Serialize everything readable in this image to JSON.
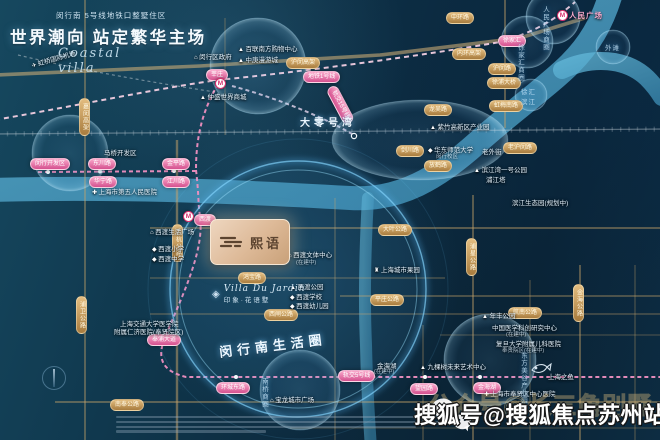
{
  "header": {
    "tagline": "闵行南 5号线地铁口整墅住区",
    "title": "世界潮向 站定繁华主场",
    "script": "Coastal villa"
  },
  "project": {
    "logo": "熙语",
    "script": "Villa Du Jardin",
    "name": "印象·花语墅"
  },
  "watermark": {
    "text": "搜狐号@搜狐焦点苏州站",
    "ghost": "公众号@长三角别墅"
  },
  "colors": {
    "station_pink": "#d5518f",
    "road_gold": "#a87c3e",
    "river_blue": "#58aed2",
    "glow_cyan": "#7fd4ff",
    "card_beige": "#ddb997"
  },
  "map": {
    "icon_glyphs": {
      "tri": "▲",
      "sch": "◆",
      "hos": "✚",
      "bld": "⌂",
      "pag": "♜",
      "pln": "✈"
    },
    "stations": [
      {
        "t": "莘庄",
        "x": 206,
        "y": 69
      },
      {
        "t": "闵行开发区",
        "x": 30,
        "y": 158
      },
      {
        "t": "东川路",
        "x": 88,
        "y": 158
      },
      {
        "t": "金平路",
        "x": 162,
        "y": 158
      },
      {
        "t": "华宁路",
        "x": 89,
        "y": 176
      },
      {
        "t": "江川路",
        "x": 162,
        "y": 176
      },
      {
        "t": "西渡",
        "x": 194,
        "y": 214
      },
      {
        "t": "奉浦大道",
        "x": 147,
        "y": 334
      },
      {
        "t": "环城东路",
        "x": 216,
        "y": 382
      },
      {
        "t": "望园路",
        "x": 410,
        "y": 383
      },
      {
        "t": "金海湖",
        "x": 473,
        "y": 382
      },
      {
        "t": "徐家汇",
        "x": 498,
        "y": 35
      },
      {
        "t": "地铁1号线",
        "x": 303,
        "y": 71
      },
      {
        "t": "轨交5号线",
        "x": 338,
        "y": 370
      },
      {
        "t": "轨交15号线",
        "x": 336,
        "y": 84,
        "rot": 62
      }
    ],
    "roads": [
      {
        "t": "中环路",
        "x": 446,
        "y": 12
      },
      {
        "t": "内环高架",
        "x": 452,
        "y": 48
      },
      {
        "t": "沪闵路",
        "x": 488,
        "y": 63
      },
      {
        "t": "徐浦大桥",
        "x": 487,
        "y": 77
      },
      {
        "t": "沪闵高架",
        "x": 286,
        "y": 57
      },
      {
        "t": "嘉闵高架",
        "x": 79,
        "y": 98,
        "v": 1
      },
      {
        "t": "龙吴路",
        "x": 424,
        "y": 104
      },
      {
        "t": "虹梅南路",
        "x": 489,
        "y": 100
      },
      {
        "t": "剑川路",
        "x": 396,
        "y": 145
      },
      {
        "t": "老沪闵路",
        "x": 503,
        "y": 142
      },
      {
        "t": "放鹤路",
        "x": 424,
        "y": 160
      },
      {
        "t": "沪杭公路",
        "x": 172,
        "y": 224,
        "v": 1
      },
      {
        "t": "大叶公路",
        "x": 378,
        "y": 224
      },
      {
        "t": "浦星公路",
        "x": 466,
        "y": 238,
        "v": 1
      },
      {
        "t": "鸿宝路",
        "x": 238,
        "y": 272
      },
      {
        "t": "平庄公路",
        "x": 370,
        "y": 294
      },
      {
        "t": "西闸公路",
        "x": 264,
        "y": 309
      },
      {
        "t": "航南公路",
        "x": 508,
        "y": 307
      },
      {
        "t": "金海公路",
        "x": 573,
        "y": 284,
        "v": 1
      },
      {
        "t": "浦卫公路",
        "x": 76,
        "y": 296,
        "v": 1
      },
      {
        "t": "南奉公路",
        "x": 110,
        "y": 399
      }
    ],
    "places": [
      {
        "t": "百联南方购物中心",
        "x": 238,
        "y": 43,
        "ic": "tri"
      },
      {
        "t": "中庚漫游城",
        "x": 238,
        "y": 54,
        "ic": "tri"
      },
      {
        "t": "闵行区政府",
        "x": 194,
        "y": 51,
        "ic": "bld"
      },
      {
        "t": "仲盛世界商城",
        "x": 200,
        "y": 91,
        "ic": "tri"
      },
      {
        "t": "虹桥国际机场",
        "x": 30,
        "y": 60,
        "ic": "pln",
        "rot": -16
      },
      {
        "t": "马桥开发区",
        "x": 104,
        "y": 147
      },
      {
        "t": "上海市第五人民医院",
        "x": 92,
        "y": 186,
        "ic": "hos"
      },
      {
        "t": "紫竹高新区产业园",
        "x": 430,
        "y": 121,
        "ic": "tri"
      },
      {
        "t": "华东师范大学",
        "x": 428,
        "y": 144,
        "ic": "sch"
      },
      {
        "t": "闵行校区",
        "x": 436,
        "y": 152,
        "cls": "dim"
      },
      {
        "t": "老外街",
        "x": 482,
        "y": 146
      },
      {
        "t": "滨江湾一号公园",
        "x": 474,
        "y": 164,
        "ic": "tri"
      },
      {
        "t": "浦江塔",
        "x": 486,
        "y": 174
      },
      {
        "t": "滨江生态园(规划中)",
        "x": 512,
        "y": 197
      },
      {
        "t": "西渡生活广场",
        "x": 150,
        "y": 226,
        "ic": "bld"
      },
      {
        "t": "西渡小学",
        "x": 152,
        "y": 243,
        "ic": "sch"
      },
      {
        "t": "西渡中学",
        "x": 152,
        "y": 253,
        "ic": "sch"
      },
      {
        "t": "西渡文体中心",
        "x": 288,
        "y": 249,
        "ic": "bld"
      },
      {
        "t": "(在建中)",
        "x": 296,
        "y": 258,
        "cls": "dim"
      },
      {
        "t": "西渡公园",
        "x": 290,
        "y": 281,
        "ic": "tri"
      },
      {
        "t": "西渡学校",
        "x": 290,
        "y": 291,
        "ic": "sch"
      },
      {
        "t": "西渡幼儿园",
        "x": 290,
        "y": 300,
        "ic": "sch"
      },
      {
        "t": "上海城市果园",
        "x": 374,
        "y": 264,
        "ic": "pag"
      },
      {
        "t": "上海交通大学医学院",
        "x": 120,
        "y": 318
      },
      {
        "t": "附属仁济医院(奉贤院区)",
        "x": 114,
        "y": 326
      },
      {
        "t": "年丰公园",
        "x": 482,
        "y": 310,
        "ic": "tri"
      },
      {
        "t": "九棵树未来艺术中心",
        "x": 420,
        "y": 361,
        "ic": "tri"
      },
      {
        "t": "中国医学科创研究中心",
        "x": 492,
        "y": 322
      },
      {
        "t": "(在建中)",
        "x": 506,
        "y": 330,
        "cls": "dim"
      },
      {
        "t": "复旦大学附属儿科医院",
        "x": 496,
        "y": 338
      },
      {
        "t": "奉贤院区(在建中)",
        "x": 502,
        "y": 346,
        "cls": "dim"
      },
      {
        "t": "上海之鱼",
        "x": 548,
        "y": 371
      },
      {
        "t": "上海市奉贤区中心医院",
        "x": 484,
        "y": 388,
        "ic": "hos"
      },
      {
        "t": "宝龙城市广场",
        "x": 270,
        "y": 394,
        "ic": "bld"
      },
      {
        "t": "金海湖",
        "x": 377,
        "y": 360
      },
      {
        "t": "(在建中)",
        "x": 374,
        "y": 367,
        "cls": "dim"
      },
      {
        "t": "人民广场",
        "x": 569,
        "y": 10,
        "cls": "pinktxt"
      }
    ],
    "zones": [
      {
        "t": "人民广场商圈",
        "x": 538,
        "y": 2,
        "v": 1
      },
      {
        "t": "徐家汇商圈",
        "x": 513,
        "y": 40,
        "v": 1
      },
      {
        "t": "外滩",
        "x": 605,
        "y": 42
      },
      {
        "t": "徐汇滨江",
        "x": 521,
        "y": 86,
        "w": 16
      },
      {
        "t": "南桥商圈",
        "x": 257,
        "y": 374,
        "v": 1
      },
      {
        "t": "东方美谷产业园区",
        "x": 516,
        "y": 348,
        "v": 1
      }
    ],
    "bigs": [
      {
        "t": "大零号湾",
        "x": 300,
        "y": 114
      },
      {
        "t": "闵行南生活圈",
        "x": 218,
        "y": 342,
        "rot": -7,
        "cls": "circle-title"
      }
    ],
    "metro_icons": [
      {
        "x": 215,
        "y": 78
      },
      {
        "x": 183,
        "y": 211
      },
      {
        "x": 557,
        "y": 10
      }
    ]
  }
}
